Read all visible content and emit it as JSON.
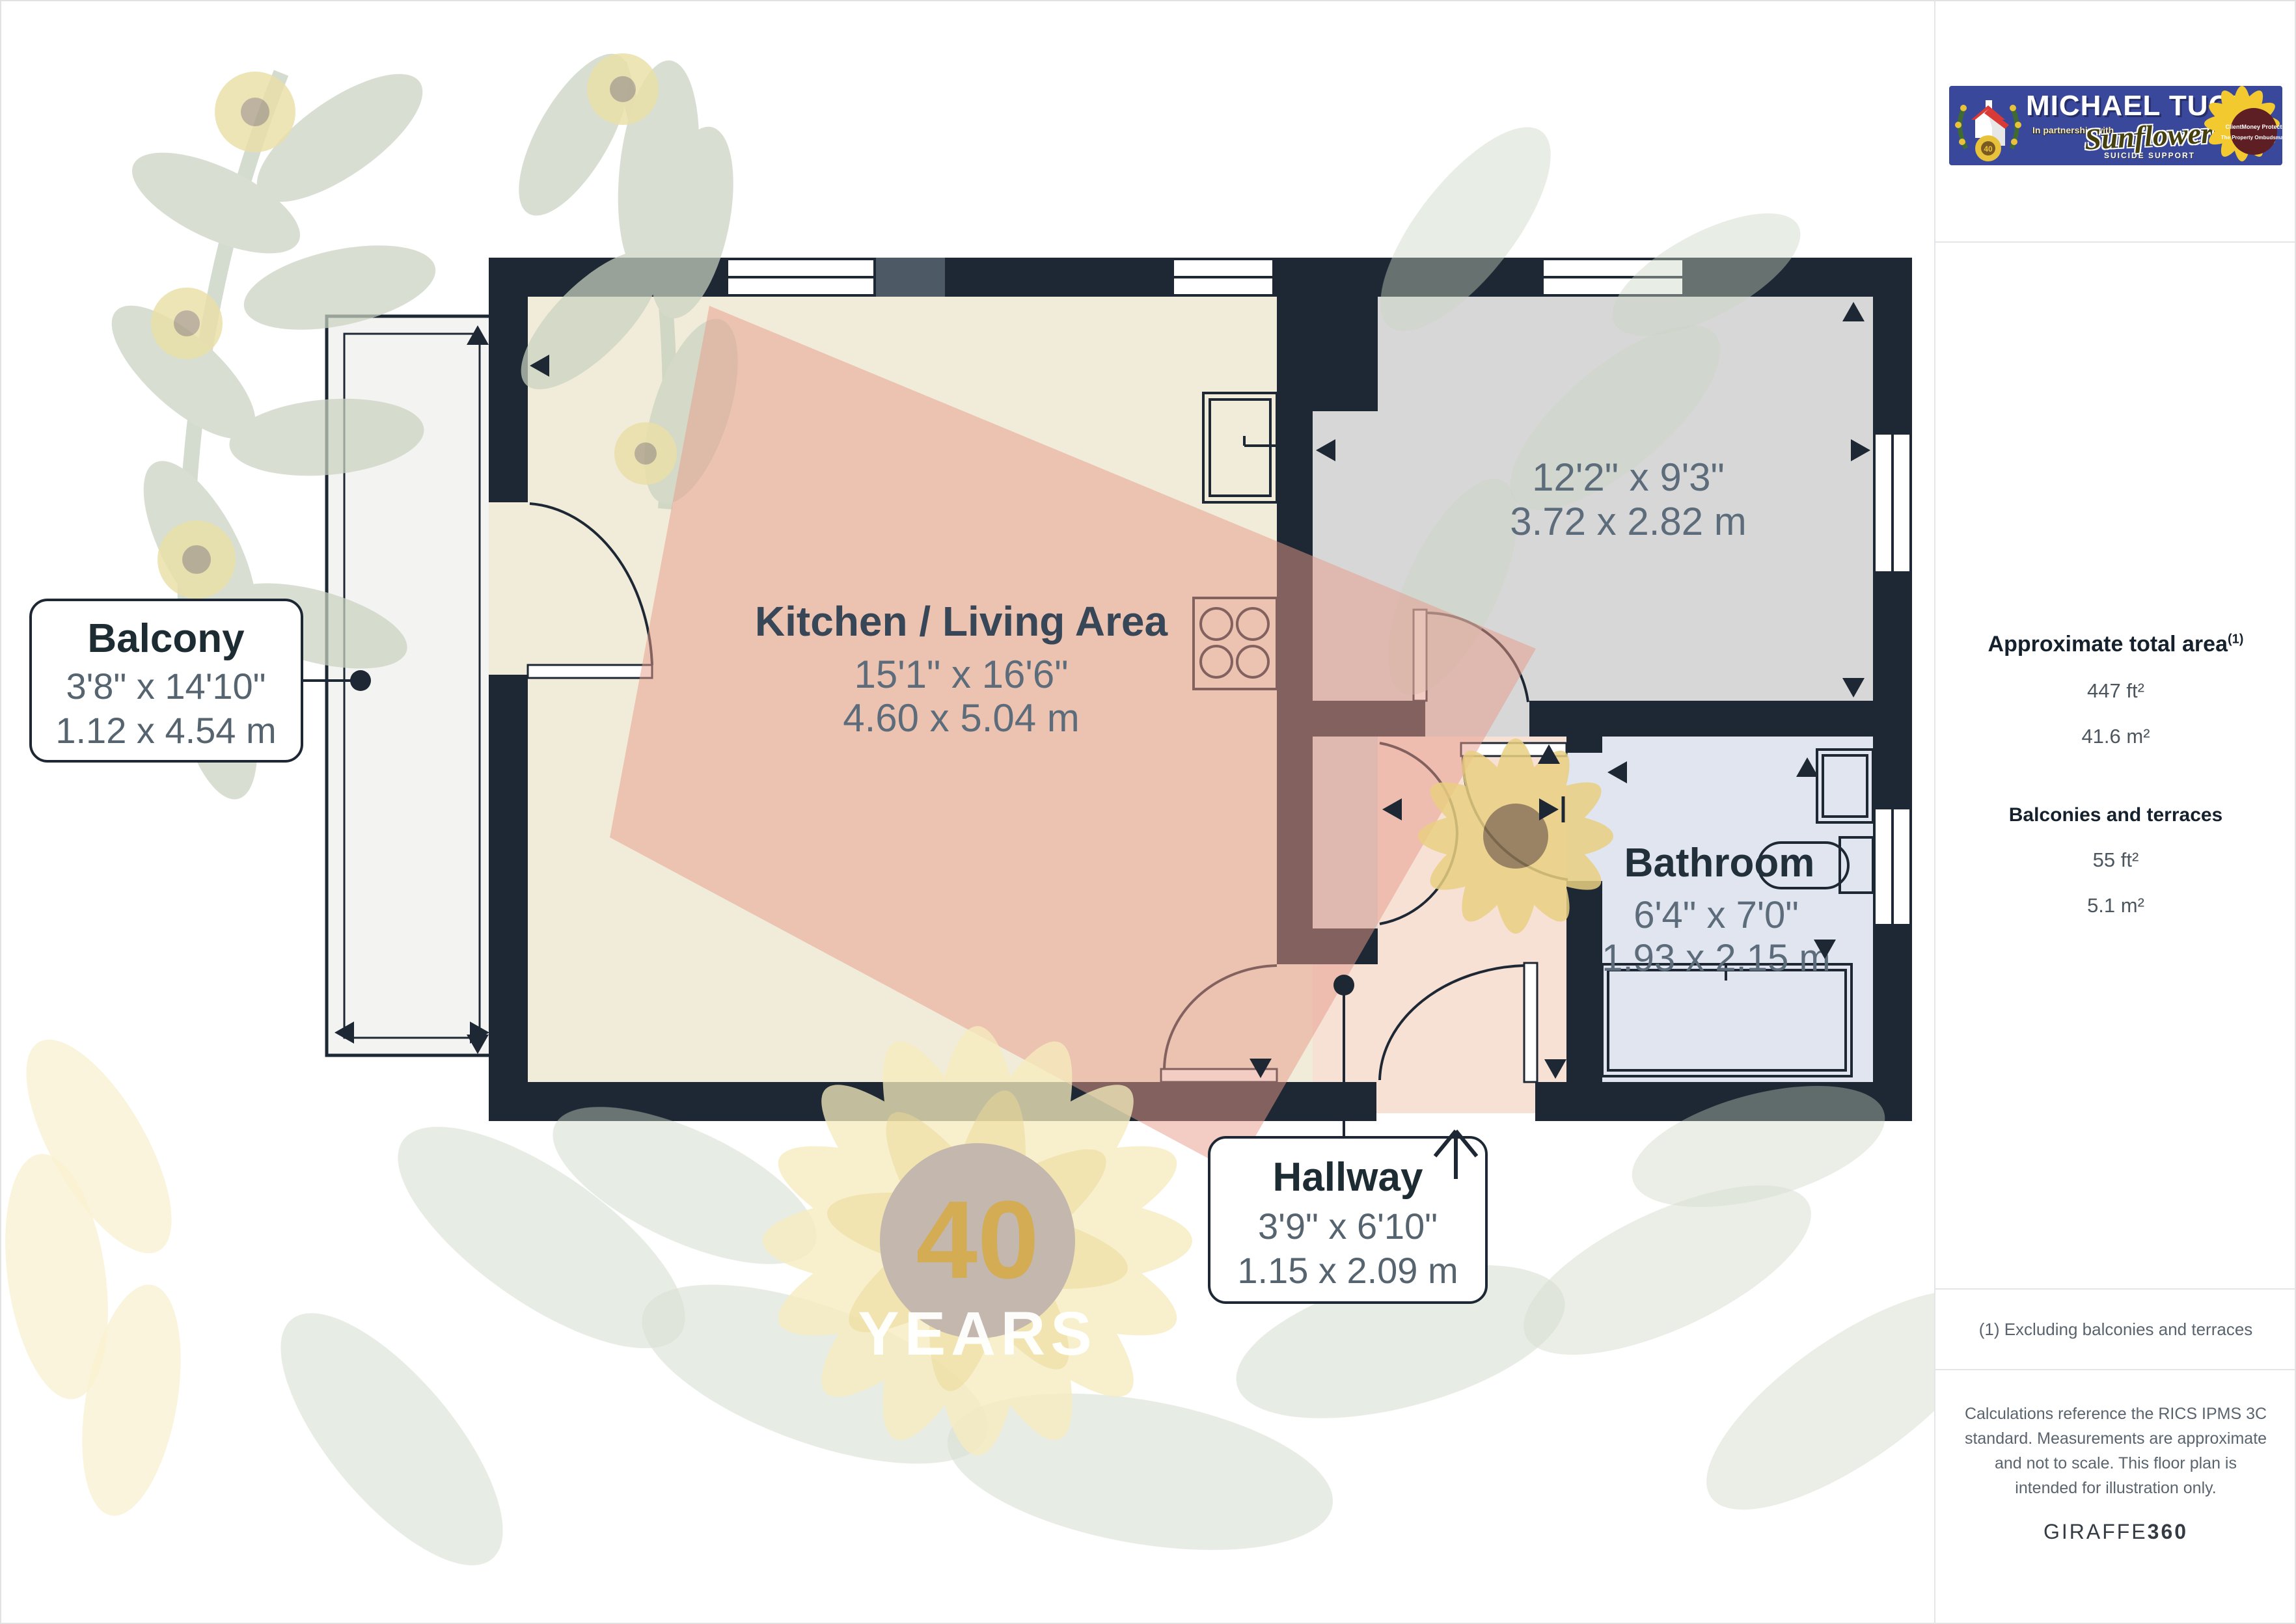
{
  "floorplan": {
    "rooms": {
      "kitchen": {
        "name": "Kitchen / Living Area",
        "dims_imperial": "15'1\" x 16'6\"",
        "dims_metric": "4.60 x 5.04 m"
      },
      "bedroom": {
        "dims_imperial": "12'2\" x 9'3\"",
        "dims_metric": "3.72 x 2.82 m"
      },
      "bathroom": {
        "name": "Bathroom",
        "dims_imperial": "6'4\" x 7'0\"",
        "dims_metric": "1.93 x 2.15 m"
      },
      "hallway": {
        "name": "Hallway",
        "dims_imperial": "3'9\" x 6'10\"",
        "dims_metric": "1.15 x 2.09 m"
      },
      "balcony": {
        "name": "Balcony",
        "dims_imperial": "3'8\" x 14'10\"",
        "dims_metric": "1.12 x 4.54 m"
      }
    },
    "watermark": {
      "badge_number": "40",
      "badge_text": "YEARS"
    }
  },
  "sidebar": {
    "logo": {
      "brand": "MICHAEL TUCK",
      "partnership": "In partnership with",
      "charity": "Sunflowers",
      "charity_sub": "SUICIDE SUPPORT",
      "badge1": "ClientMoney Protect",
      "badge2": "The Property Ombudsman",
      "badge_mini": "40"
    },
    "area": {
      "title": "Approximate total area",
      "superscript": "(1)",
      "total_ft": "447 ft²",
      "total_m": "41.6 m²",
      "balconies_title": "Balconies and terraces",
      "balconies_ft": "55 ft²",
      "balconies_m": "5.1 m²"
    },
    "footnote": "(1) Excluding balconies and terraces",
    "disclaimer": "Calculations reference the RICS IPMS 3C standard. Measurements are approximate and not to scale. This floor plan is intended for illustration only.",
    "brand_footer": {
      "name": "GIRAFFE",
      "suffix": "360"
    }
  },
  "colors": {
    "wall": "#1d2834",
    "kitchen_floor": "#f1ecd9",
    "bedroom_floor": "#d7d7d7",
    "bathroom_floor": "#e0e5ef",
    "hallway_floor": "#f7e0d4",
    "balcony_floor": "#f3f3f1",
    "watermark_leaf": "#c9d3c1",
    "watermark_pink": "#e8998a",
    "logo_blue": "#3a489c"
  }
}
